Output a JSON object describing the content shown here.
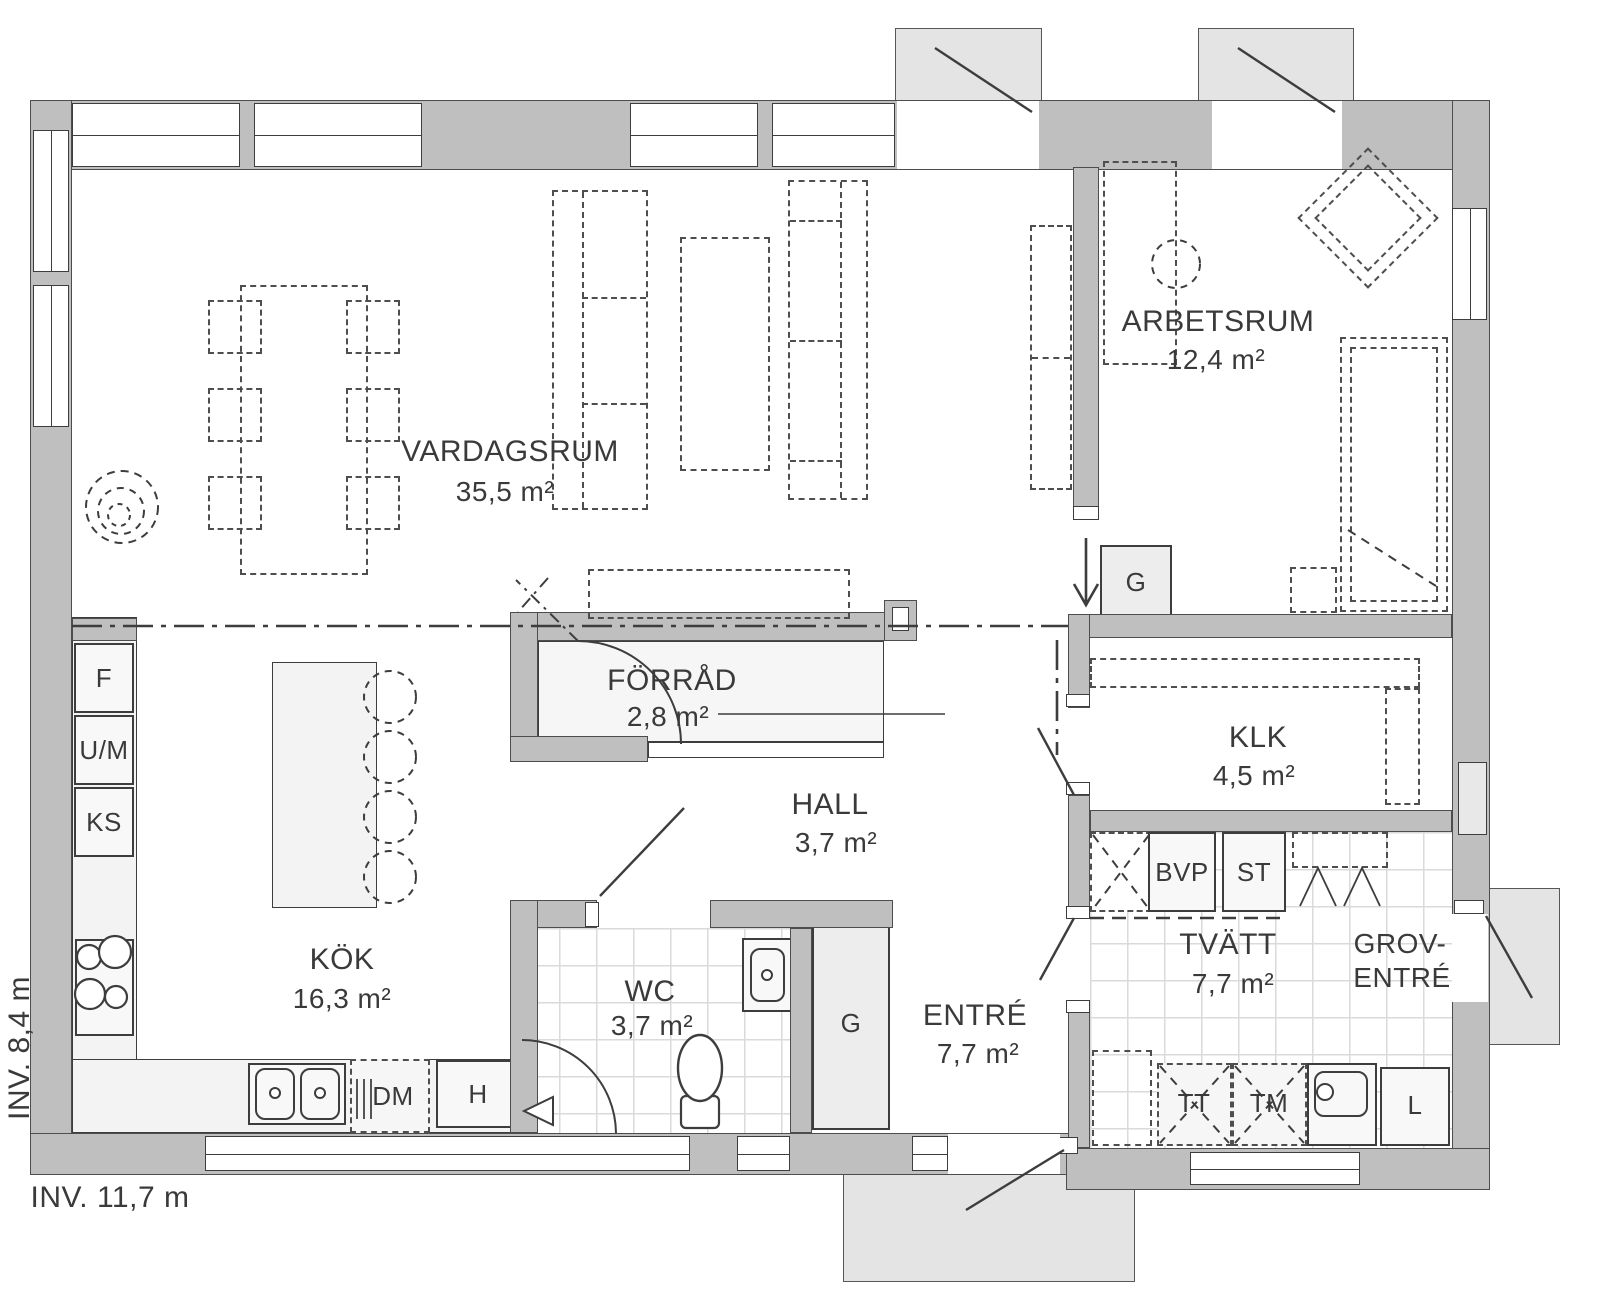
{
  "title": "Floor plan",
  "rooms": [
    {
      "id": "vardagsrum",
      "name": "VARDAGSRUM",
      "area": "35,5 m²"
    },
    {
      "id": "arbetsrum",
      "name": "ARBETSRUM",
      "area": "12,4 m²"
    },
    {
      "id": "forrad",
      "name": "FÖRRÅD",
      "area": "2,8 m²"
    },
    {
      "id": "klk",
      "name": "KLK",
      "area": "4,5 m²"
    },
    {
      "id": "hall",
      "name": "HALL",
      "area": "3,7 m²"
    },
    {
      "id": "kok",
      "name": "KÖK",
      "area": "16,3 m²"
    },
    {
      "id": "wc",
      "name": "WC",
      "area": "3,7 m²"
    },
    {
      "id": "entre",
      "name": "ENTRÉ",
      "area": "7,7 m²"
    },
    {
      "id": "tvatt",
      "name": "TVÄTT",
      "area": "7,7 m²"
    },
    {
      "id": "groventre",
      "name": "GROV-",
      "name2": "ENTRÉ"
    }
  ],
  "fixtures": {
    "freezer": "F",
    "oven_micro": "U/M",
    "fridge": "KS",
    "dishwasher": "DM",
    "h_cabinet": "H",
    "wardrobe_hall": "G",
    "wardrobe_arbetsrum": "G",
    "heat_pump": "BVP",
    "st_cabinet": "ST",
    "dryer": "TT",
    "washer": "TM",
    "linen_cabinet": "L"
  },
  "dimensions": {
    "inner_width_label": "INV. 11,7 m",
    "inner_height_label": "INV. 8,4 m"
  },
  "colors": {
    "wall": "#bfbfbf",
    "porch": "#e4e4e4",
    "line": "#3d3d3d",
    "tile_line": "#dadada",
    "fixture_fill": "#f8f8f8"
  }
}
